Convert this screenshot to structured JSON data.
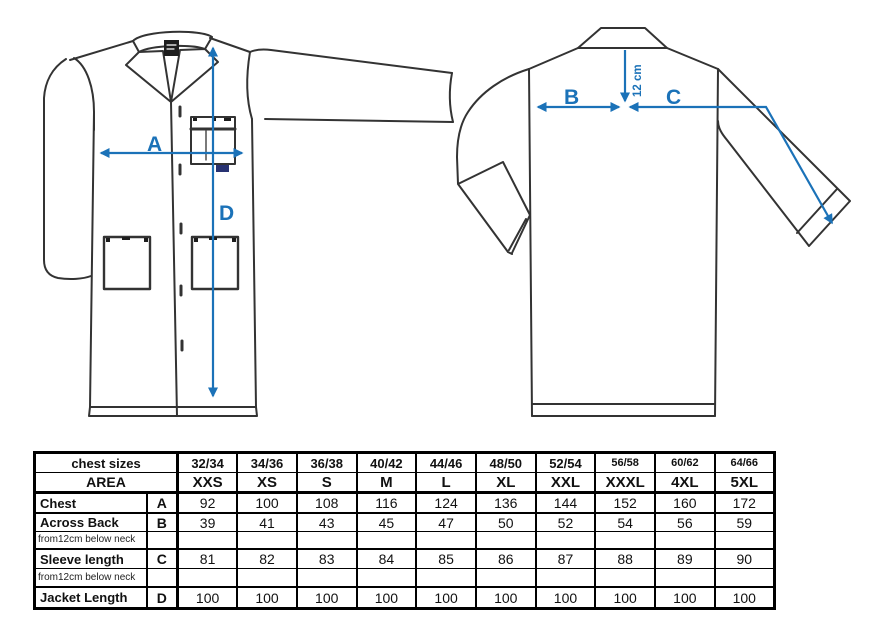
{
  "diagram": {
    "arrow_color": "#1b72b8",
    "line_color": "#333333",
    "front_view": {
      "chest_label": "A",
      "length_label": "D"
    },
    "back_view": {
      "across_back_label": "B",
      "sleeve_length_label": "C",
      "neck_offset_label": "12 cm"
    }
  },
  "size_table": {
    "header_row1_label": "chest sizes",
    "header_row2_label": "AREA",
    "chest_sizes": [
      "32/34",
      "34/36",
      "36/38",
      "40/42",
      "44/46",
      "48/50",
      "52/54",
      "56/58",
      "60/62",
      "64/66"
    ],
    "sizes": [
      "XXS",
      "XS",
      "S",
      "M",
      "L",
      "XL",
      "XXL",
      "XXXL",
      "4XL",
      "5XL"
    ],
    "rows": [
      {
        "label": "Chest",
        "letter": "A",
        "values": [
          "92",
          "100",
          "108",
          "116",
          "124",
          "136",
          "144",
          "152",
          "160",
          "172"
        ]
      },
      {
        "label": "Across Back",
        "letter": "B",
        "note": "from12cm below neck",
        "values": [
          "39",
          "41",
          "43",
          "45",
          "47",
          "50",
          "52",
          "54",
          "56",
          "59"
        ]
      },
      {
        "label": "Sleeve length",
        "letter": "C",
        "note": "from12cm below neck",
        "values": [
          "81",
          "82",
          "83",
          "84",
          "85",
          "86",
          "87",
          "88",
          "89",
          "90"
        ]
      },
      {
        "label": "Jacket Length",
        "letter": "D",
        "values": [
          "100",
          "100",
          "100",
          "100",
          "100",
          "100",
          "100",
          "100",
          "100",
          "100"
        ]
      }
    ]
  }
}
